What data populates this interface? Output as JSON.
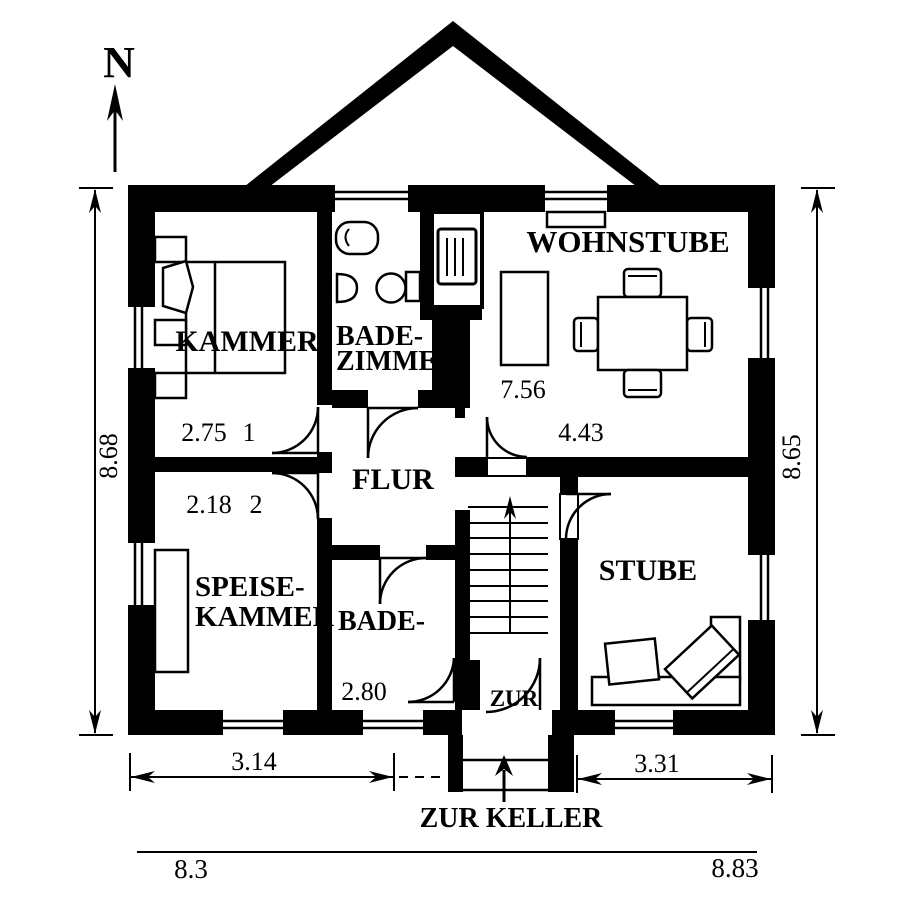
{
  "colors": {
    "ink": "#000000",
    "paper": "#ffffff"
  },
  "compass": {
    "label": "N"
  },
  "rooms": {
    "kammer": {
      "label": "KAMMER",
      "dim": "2.75",
      "number": "1"
    },
    "badezimmer": {
      "label_line1": "BADE-",
      "label_line2": "ZIMMER"
    },
    "wohnstube": {
      "label": "WOHNSTUBE",
      "dim_a": "7.56",
      "dim_b": "4.43"
    },
    "flur": {
      "label": "FLUR"
    },
    "speisekammer": {
      "label_line1": "SPEISE-",
      "label_line2": "KAMMER",
      "dim": "2.18",
      "number": "2"
    },
    "bade": {
      "label": "BADE-",
      "dim": "2.80"
    },
    "stube": {
      "label": "STUBE"
    },
    "zur": {
      "label": "ZUR"
    }
  },
  "annotations": {
    "keller": "ZUR KELLER"
  },
  "dimensions": {
    "left_height": "8.68",
    "right_height": "8.65",
    "bottom_left": "3.14",
    "bottom_right": "3.31",
    "overall_left": "8.3",
    "overall_right": "8.83"
  }
}
